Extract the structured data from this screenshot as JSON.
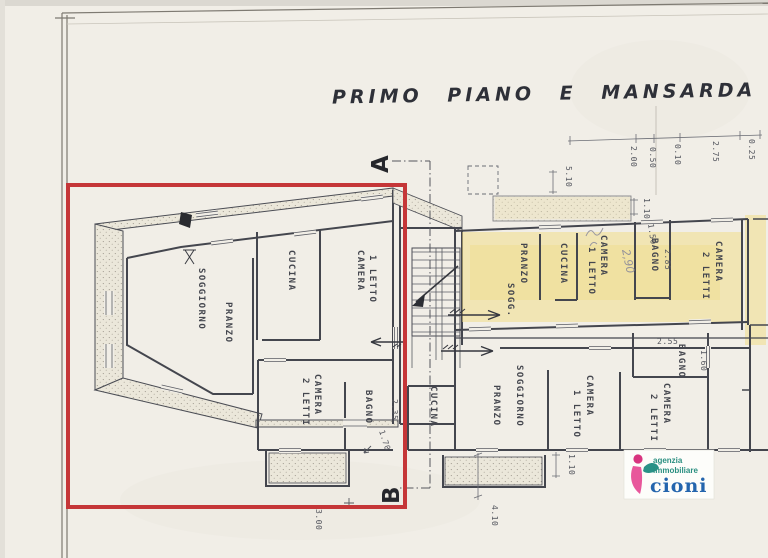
{
  "title": "PRIMO PIANO E MANSARDA",
  "markers": {
    "a": "A",
    "b": "B"
  },
  "top_dims": [
    "2.00",
    "0.50",
    "0.10",
    "2.75",
    "0.25"
  ],
  "apt_left": {
    "soggiorno": "SOGGIORNO",
    "pranzo": "PRANZO",
    "cucina": "CUCINA",
    "camera1a": "CAMERA",
    "camera1b": "1 LETTO",
    "camera2a": "CAMERA",
    "camera2b": "2 LETTI",
    "bagno": "BAGNO",
    "dim_bagno_w": "2.35",
    "dim_bagno_h": "1.70"
  },
  "apt_top": {
    "pranzo": "PRANZO",
    "sogg": "SOGG.",
    "cucina": "CUCINA",
    "camera1a": "CAMERA",
    "camera1b": "1 LETTO",
    "bagno": "BAGNO",
    "camera2a": "CAMERA",
    "camera2b": "2 LETTI",
    "dim_bagno": "2.85",
    "dim_door": "1.50",
    "dim_balcony": "5.10",
    "dim_balcony_depth": "1.10",
    "pencil_note": "2,90"
  },
  "apt_bottom": {
    "cucina": "CUCINA",
    "pranzo": "PRANZO",
    "soggiorno": "SOGGIORNO",
    "camera1a": "CAMERA",
    "camera1b": "1 LETTO",
    "camera2a": "CAMERA",
    "camera2b": "2 LETTI",
    "bagno": "BAGNO",
    "dim_bagno": "2.55",
    "dim_door": "1.60",
    "dim_balcony": "1.10",
    "dim_right": "4.10",
    "dim_left": "3.00"
  },
  "logo": {
    "line1": "agenzia",
    "line2": "immobiliare",
    "line3": "cioni"
  },
  "colors": {
    "highlight_red": "#c53638",
    "highlight_yellow": "#f2dc82",
    "paper": "#f1eee7",
    "ink": "#44464e",
    "logo_pink": "#d8347f",
    "logo_teal": "#2a8f80",
    "logo_blue": "#2465ad"
  }
}
